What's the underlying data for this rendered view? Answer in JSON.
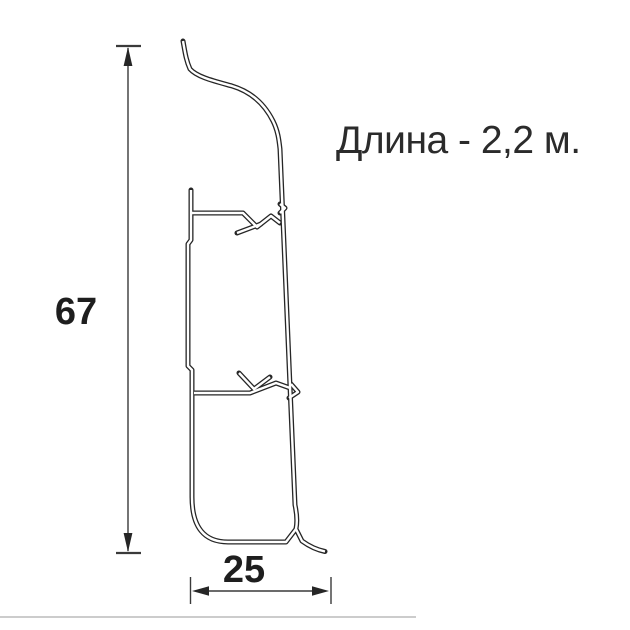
{
  "drawing": {
    "subject": "plinth-profile-cross-section",
    "line_color": "#262626",
    "dim_color": "#3a3a3a",
    "text_color": "#1e1e1e",
    "faint_line_color": "#cccccc"
  },
  "annotation": {
    "length_note": "Длина - 2,2 м."
  },
  "dimensions": {
    "height_value": "67",
    "width_value": "25"
  }
}
